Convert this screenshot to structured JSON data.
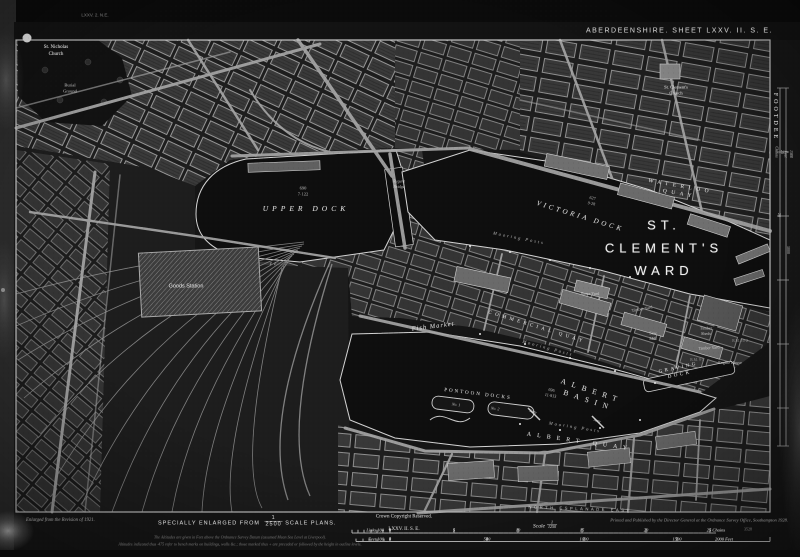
{
  "palette": {
    "paper": "#171717",
    "water": "#0e0e0e",
    "ink": "#d9d9d9",
    "bright_block": "#6f6f6f"
  },
  "header": {
    "sheet_title": "ABERDEENSHIRE. SHEET LXXV. II. S. E."
  },
  "footer": {
    "enlarged_note": "Enlarged from the Revision of 1921.",
    "specially_prefix": "SPECIALLY ENLARGED FROM",
    "specially_frac_num": "1",
    "specially_frac_den": "2500",
    "specially_suffix": "SCALE PLANS.",
    "altitude_note_1": "The Altitudes are given in Feet above the Ordnance Survey Datum (assumed Mean Sea Level at Liverpool).",
    "altitude_note_2": "Altitudes indicated thus ·475 refer to bench marks on buildings, walls &c.; those marked thus + are preceded or followed by the height in outline levels.",
    "crown": "Crown Copyright Reserved.",
    "sheet_ref": "LXXV. II. S. E.",
    "scale_word": "Scale",
    "scale_frac_num": "1",
    "scale_frac_den": "1250",
    "links_label": "Links 100",
    "feet_label": "Feet 100",
    "links_ticks": [
      {
        "t": "0",
        "x": 390
      },
      {
        "t": "5",
        "x": 454
      },
      {
        "t": "10",
        "x": 518
      },
      {
        "t": "15",
        "x": 582
      },
      {
        "t": "20",
        "x": 646
      },
      {
        "t": "25 Chains",
        "x": 716
      }
    ],
    "feet_ticks": [
      {
        "t": "0",
        "x": 390
      },
      {
        "t": "500",
        "x": 487
      },
      {
        "t": "1000",
        "x": 584
      },
      {
        "t": "1500",
        "x": 677
      },
      {
        "t": "2000 Feet",
        "x": 724
      }
    ],
    "printer": "Printed and Published by the Director General at the Ordnance Survey Office, Southampton 1928.",
    "print_code": "3528"
  },
  "map": {
    "labels": [
      {
        "id": "adjoining-sheet-north",
        "t": "LXXV. 2. N.E.",
        "x": 95,
        "y": 15,
        "s": 4.5,
        "cls": "sans dim2"
      },
      {
        "id": "st-nicholas-church",
        "t": "St. Nicholas\nChurch",
        "x": 56,
        "y": 50,
        "s": 5,
        "cls": "ser"
      },
      {
        "id": "burial-ground",
        "t": "Burial\nGround",
        "x": 70,
        "y": 88,
        "s": 4.5,
        "cls": "ser dim"
      },
      {
        "id": "st-clements-church",
        "t": "St. Clement's\nChurch",
        "x": 676,
        "y": 90,
        "s": 4.5,
        "cls": "ser"
      },
      {
        "id": "upper-dock",
        "t": "UPPER DOCK",
        "x": 306,
        "y": 209,
        "s": 7.5,
        "ls": 4,
        "cls": "serit sp"
      },
      {
        "id": "upper-dock-area",
        "t": "690\n7·122",
        "x": 303,
        "y": 191,
        "s": 4.5,
        "cls": "ser dim"
      },
      {
        "id": "regent-bridge",
        "t": "Regent\nBridge",
        "x": 399,
        "y": 184,
        "s": 4.2,
        "cls": "serit dim"
      },
      {
        "id": "waterloo-quay",
        "t": "WATERLOO QUAY",
        "x": 680,
        "y": 190,
        "rot": 10,
        "s": 5.5,
        "ls": 4.5,
        "cls": "ser sp"
      },
      {
        "id": "victoria-dock",
        "t": "VICTORIA DOCK",
        "x": 580,
        "y": 217,
        "rot": 17,
        "s": 7,
        "ls": 3,
        "cls": "serit sp"
      },
      {
        "id": "victoria-dock-area",
        "t": "627\n9·28",
        "x": 592,
        "y": 201,
        "rot": 12,
        "s": 4.2,
        "cls": "ser dim"
      },
      {
        "id": "ward-name",
        "t": "ST. CLEMENT'S\nWARD",
        "x": 664,
        "y": 248,
        "s": 13,
        "ls": 5,
        "cls": "sans big"
      },
      {
        "id": "mooring-posts-1",
        "t": "Mooring Posts",
        "x": 519,
        "y": 238,
        "rot": 11,
        "s": 4.5,
        "ls": 2,
        "cls": "serit dim"
      },
      {
        "id": "fish-market",
        "t": "Fish Market",
        "x": 433,
        "y": 326,
        "rot": -7,
        "s": 6.5,
        "ls": 1,
        "cls": "serit"
      },
      {
        "id": "commercial-quay",
        "t": "COMMERCIAL QUAY",
        "x": 537,
        "y": 327,
        "rot": 17,
        "s": 5,
        "ls": 3.5,
        "cls": "ser sp"
      },
      {
        "id": "mooring-posts-2",
        "t": "Mooring Posts",
        "x": 548,
        "y": 348,
        "rot": 15,
        "s": 4.5,
        "ls": 2,
        "cls": "serit dim"
      },
      {
        "id": "albert-basin",
        "t": "ALBERT BASIN",
        "x": 590,
        "y": 396,
        "rot": 18,
        "s": 7.5,
        "ls": 6,
        "cls": "ser sp"
      },
      {
        "id": "albert-basin-area",
        "t": "696\n11·813",
        "x": 551,
        "y": 393,
        "rot": 10,
        "s": 4.2,
        "cls": "ser dim"
      },
      {
        "id": "pontoon-docks",
        "t": "PONTOON DOCKS",
        "x": 478,
        "y": 394,
        "rot": 7,
        "s": 5,
        "ls": 2,
        "cls": "ser sp"
      },
      {
        "id": "pontoon-no1",
        "t": "No. 1",
        "x": 456,
        "y": 405,
        "rot": 7,
        "s": 4,
        "cls": "serit dim"
      },
      {
        "id": "pontoon-no2",
        "t": "No. 2",
        "x": 495,
        "y": 409,
        "rot": 7,
        "s": 4,
        "cls": "serit dim"
      },
      {
        "id": "jetty-1",
        "t": "Jetty",
        "x": 533,
        "y": 412,
        "rot": 18,
        "s": 4,
        "cls": "serit dim"
      },
      {
        "id": "jetty-2",
        "t": "Jetty",
        "x": 597,
        "y": 421,
        "rot": 18,
        "s": 4,
        "cls": "serit dim"
      },
      {
        "id": "mooring-posts-3",
        "t": "Mooring Posts",
        "x": 575,
        "y": 427,
        "rot": 9,
        "s": 4.5,
        "ls": 2,
        "cls": "serit dim"
      },
      {
        "id": "albert-quay",
        "t": "ALBERT QUAY",
        "x": 580,
        "y": 441,
        "rot": 8,
        "s": 6,
        "ls": 6,
        "cls": "ser sp"
      },
      {
        "id": "graving-dock",
        "t": "GRAVING DOCK",
        "x": 679,
        "y": 371,
        "rot": -12,
        "s": 5,
        "ls": 2.5,
        "cls": "ser sp"
      },
      {
        "id": "stone-yard",
        "t": "Stone Yard",
        "x": 590,
        "y": 294,
        "s": 4.2,
        "cls": "ser dim"
      },
      {
        "id": "timber-yard-1",
        "t": "Timber Yard",
        "x": 642,
        "y": 309,
        "rot": -10,
        "s": 4.2,
        "cls": "ser dim"
      },
      {
        "id": "saw-mill",
        "t": "Saw\nMill",
        "x": 653,
        "y": 336,
        "s": 4.2,
        "cls": "ser dim"
      },
      {
        "id": "timber-sheds",
        "t": "Timber\nSheds",
        "x": 706,
        "y": 331,
        "s": 4.2,
        "cls": "ser dim"
      },
      {
        "id": "timber-yard-2",
        "t": "Timber Yard",
        "x": 709,
        "y": 348,
        "rot": -4,
        "s": 4.2,
        "cls": "ser dim"
      },
      {
        "id": "engine-house",
        "t": "Engine House",
        "x": 730,
        "y": 363,
        "s": 4.2,
        "cls": "ser dim"
      },
      {
        "id": "bench-mark-1",
        "t": "B.M. 10·2",
        "x": 740,
        "y": 341,
        "s": 3.8,
        "cls": "ser dim2"
      },
      {
        "id": "bench-mark-2",
        "t": "B.M. 9·1",
        "x": 697,
        "y": 360,
        "s": 3.8,
        "cls": "ser dim2"
      },
      {
        "id": "goods-station",
        "t": "Goods Station",
        "x": 186,
        "y": 286,
        "s": 5.5,
        "cls": "sans"
      },
      {
        "id": "north-esplanade-east",
        "t": "NORTH ESPLANADE EAST",
        "x": 580,
        "y": 509,
        "rot": 2,
        "s": 4.2,
        "ls": 2.5,
        "cls": "sans sp dim"
      },
      {
        "id": "footdee",
        "t": "FOOTDEE",
        "x": 776,
        "y": 117,
        "rot": 90,
        "s": 6,
        "ls": 3,
        "cls": "ser sp"
      },
      {
        "id": "margin-25-chains",
        "t": "25 Chains",
        "x": 779,
        "y": 152,
        "rot": 90,
        "s": 4,
        "cls": "serit dim"
      },
      {
        "id": "margin-1500-feet",
        "t": "1500 Feet",
        "x": 788,
        "y": 154,
        "rot": 90,
        "s": 4,
        "cls": "serit dim"
      },
      {
        "id": "margin-20",
        "t": "20",
        "x": 779,
        "y": 215,
        "rot": 90,
        "s": 4,
        "cls": "ser dim"
      },
      {
        "id": "margin-1000",
        "t": "1000",
        "x": 788,
        "y": 250,
        "rot": 90,
        "s": 4,
        "cls": "ser dim"
      }
    ]
  }
}
